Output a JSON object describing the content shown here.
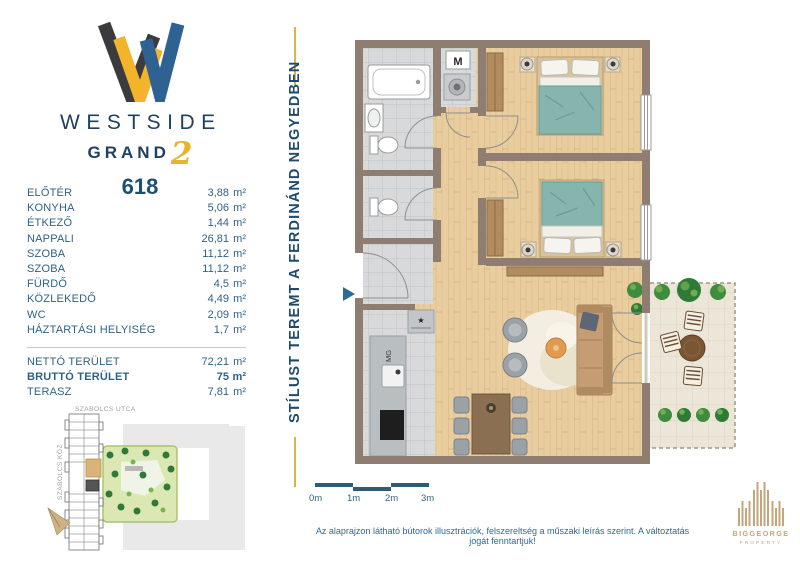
{
  "brand": {
    "line1": "WESTSIDE",
    "line2": "GRAND",
    "line2_number": "2",
    "unit_number": "618"
  },
  "tagline": {
    "text": "STÍLUST TEREMT A FERDINÁND NEGYEDBEN"
  },
  "area_table": {
    "area_unit": "m²",
    "rooms": [
      {
        "label": "ELŐTÉR",
        "area": "3,88"
      },
      {
        "label": "KONYHA",
        "area": "5,06"
      },
      {
        "label": "ÉTKEZŐ",
        "area": "1,44"
      },
      {
        "label": "NAPPALI",
        "area": "26,81"
      },
      {
        "label": "SZOBA",
        "area": "11,12"
      },
      {
        "label": "SZOBA",
        "area": "11,12"
      },
      {
        "label": "FÜRDŐ",
        "area": "4,5"
      },
      {
        "label": "KÖZLEKEDŐ",
        "area": "4,49"
      },
      {
        "label": "WC",
        "area": "2,09"
      },
      {
        "label": "HÁZTARTÁSI HELYISÉG",
        "area": "1,7"
      }
    ],
    "totals": [
      {
        "label": "NETTÓ TERÜLET",
        "area": "72,21",
        "emphasis": false
      },
      {
        "label": "BRUTTÓ TERÜLET",
        "area": "75",
        "emphasis": true
      },
      {
        "label": "TERASZ",
        "area": "7,81",
        "emphasis": false
      }
    ]
  },
  "site_map": {
    "street_top": "SZABOLCS UTCA",
    "street_left": "SZABOLCS KÖZ"
  },
  "floor_plan": {
    "appliance_labels": {
      "washing_machine": "M",
      "dishwasher": "MG",
      "boiler": "★"
    }
  },
  "scale_bar": {
    "labels": [
      "0m",
      "1m",
      "2m",
      "3m"
    ]
  },
  "disclaimer": "Az alaprajzon látható bútorok illusztrációk, felszereltség a műszaki leírás szerint. A változtatás jogát fenntartjuk!",
  "developer_logo": {
    "line1": "BIGGEORGE",
    "line2": "PROPERTY"
  },
  "colors": {
    "navy": "#20415f",
    "steel_blue": "#2f6289",
    "gold": "#e9b42d",
    "wall_taupe": "#8e7d70",
    "scale_teal": "#2d5c74",
    "disclaimer_teal": "#2c6a94",
    "developer_tan": "#c3a67b",
    "bed_teal": "#86b5ae"
  }
}
